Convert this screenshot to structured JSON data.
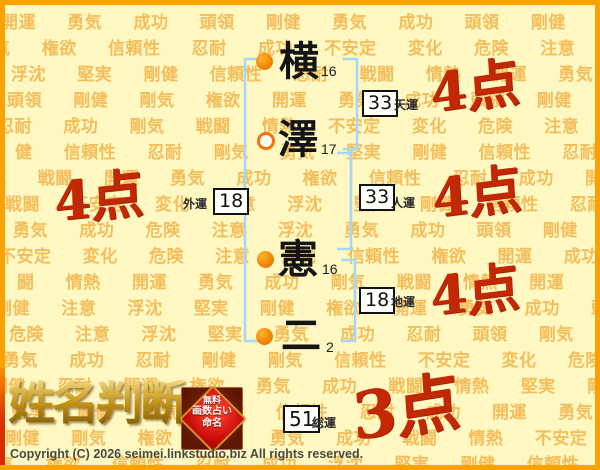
{
  "theme": {
    "bg_color": "#FFF8C3",
    "border_color": "#F9A303",
    "pattern_color": "#F5BE5C",
    "score_color": "#C22803",
    "bracket_color": "#A6D7F4",
    "bullet_color": "#F08300"
  },
  "background": {
    "words": [
      "開運",
      "勇気",
      "成功",
      "頭領",
      "剛健",
      "剛気",
      "権欲",
      "信頼性",
      "忍耐",
      "浮沈",
      "堅実",
      "不安定",
      "変化",
      "危険",
      "注意",
      "戦闘",
      "情熱"
    ],
    "rows": [
      "開運 勇気 成功 頭領 剛健 勇気 成功 頭領 剛健 剛気",
      "気 権欲 信頼性 忍耐 成功 不安定 変化 危険 注意 浮沈",
      "浮沈 堅実 剛健 信頼性 忍耐 戦闘 情熱 開運 勇気 成功",
      "頭領 剛健 剛気 権欲 開運 勇気 成功 頭領 剛健 剛気",
      "忍耐 成功 剛気 戦闘 情熱 不安定 変化 危険 注意 権欲",
      "健 信頼性 忍耐 剛気 勇気 堅実 剛健 信頼性 忍耐 剛気",
      "気 戦闘 開運 勇気 成功 権欲 信頼性 忍耐 成功 開運",
      "戦闘 不安定 変化 注意 浮沈 堅実 剛健 信頼性 忍耐 剛健",
      "勇気 成功 危険 注意 浮沈 勇気 成功 頭領 剛健 剛気",
      "不安定 変化 危険 注意 浮沈 信頼性 権欲 開運 成功 剛健",
      "闘 情熱 開運 勇気 成功 剛気 戦闘 情熱 開運 勇気",
      "剛健 注意 浮沈 堅実 剛健 権欲 開運 勇気 成功 頭領",
      "危険 注意 浮沈 堅実 勇気 成功 忍耐 頭領 剛気 戦闘",
      "勇気 成功 忍耐 剛健 剛気 信頼性 不安定 変化 危険 注意",
      "剛健 忍耐 開運 権欲 勇気 成功 戦闘 情熱 堅実 剛健",
      "堅実 剛健 剛気 権欲 信頼性 忍耐 成功 開運 勇気 頭領",
      "剛健 剛気 権欲 開運 勇気 成功 戦闘 情熱 不安定 変化",
      "気 権欲 信頼性 忍耐 成功 浮沈 堅実 剛健 信頼性 忍耐"
    ]
  },
  "name_chart": {
    "characters": [
      {
        "char": "横",
        "strokes": "16",
        "bullet": "filled"
      },
      {
        "char": "澤",
        "strokes": "17",
        "bullet": "open"
      },
      {
        "char": "憲",
        "strokes": "16",
        "bullet": "filled"
      },
      {
        "char": "二",
        "strokes": "2",
        "bullet": "filled"
      }
    ],
    "fortunes": [
      {
        "id": "tenun",
        "value": "33",
        "label": "天運",
        "score": "4点"
      },
      {
        "id": "gaiun",
        "value": "18",
        "label": "外運",
        "score": "4点"
      },
      {
        "id": "jinun",
        "value": "33",
        "label": "人運",
        "score": "4点"
      },
      {
        "id": "chiun",
        "value": "18",
        "label": "地運",
        "score": "4点"
      },
      {
        "id": "souun",
        "value": "51",
        "label": "総運",
        "score": "3点"
      }
    ]
  },
  "footer": {
    "logo_text": "姓名判断",
    "badge_lines": [
      "無料",
      "画数占い",
      "命名"
    ],
    "copyright": "Copyright (C) 2026 seimei.linkstudio.biz All rights reserved."
  }
}
